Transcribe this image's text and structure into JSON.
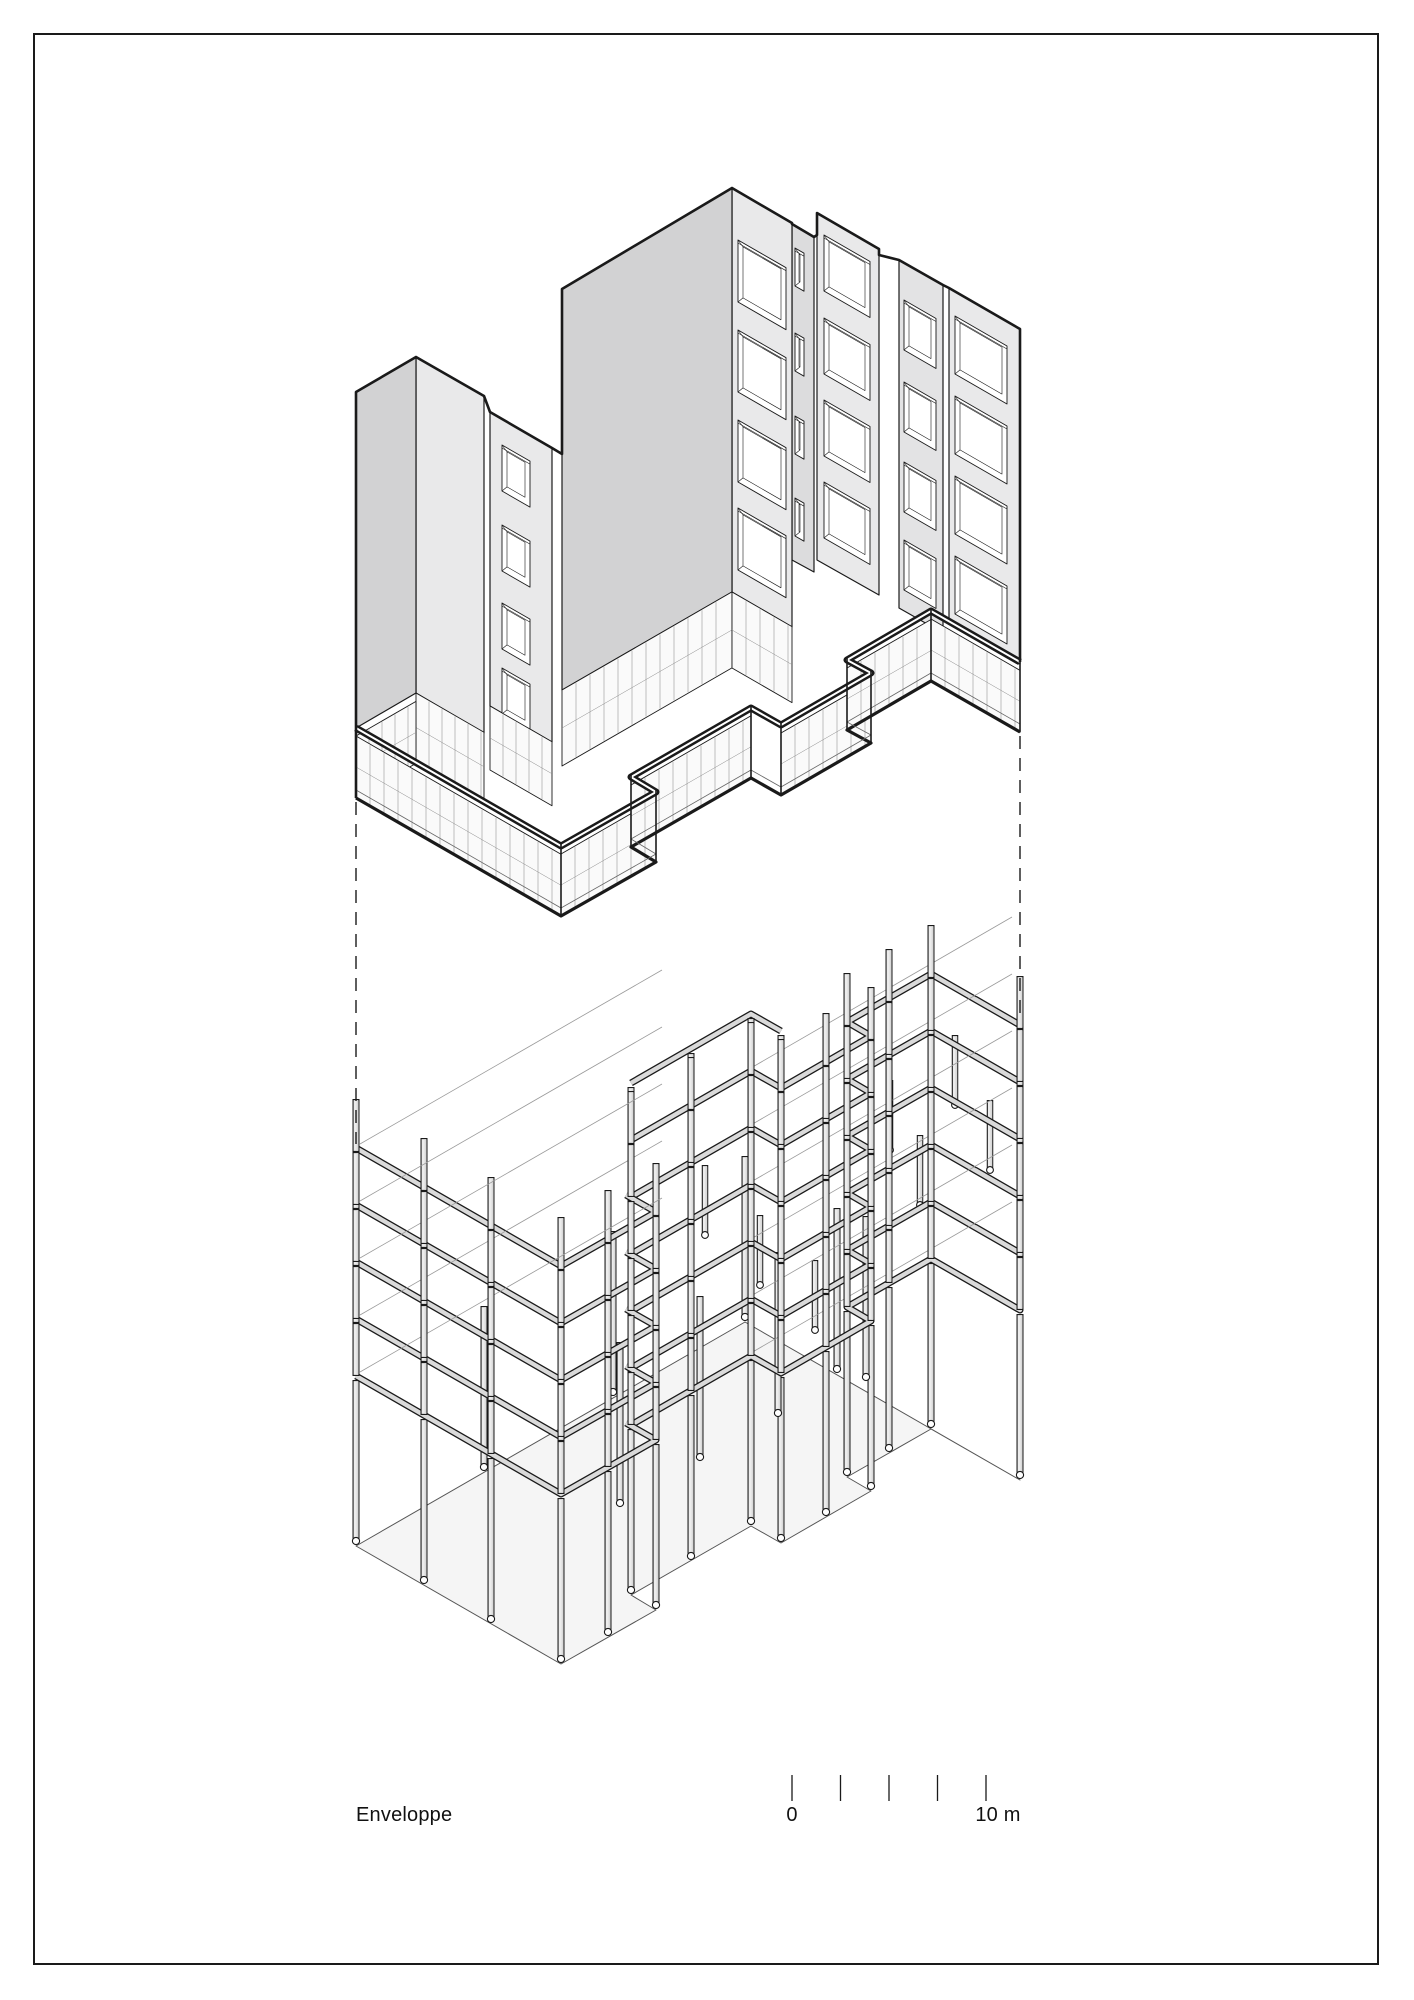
{
  "labels": {
    "envelope": "Enveloppe",
    "scale_zero": "0",
    "scale_ten": "10 m"
  },
  "scalebar": {
    "tick_count": 5,
    "length_m": 10
  },
  "colors": {
    "ink": "#1a1a1a",
    "face_left": "#d2d2d3",
    "face_right": "#e9e9ea",
    "face_slot": "#dcdcdd",
    "face_recessed": "#e3e3e4",
    "glass": "#fafafa",
    "mullion": "#8a8a8a",
    "slab_light": "#dadada",
    "column_light": "#ececec",
    "ground": "#f5f5f5",
    "hairline": "#9a9a9a",
    "white": "#ffffff",
    "border": "#1a1a1a"
  }
}
